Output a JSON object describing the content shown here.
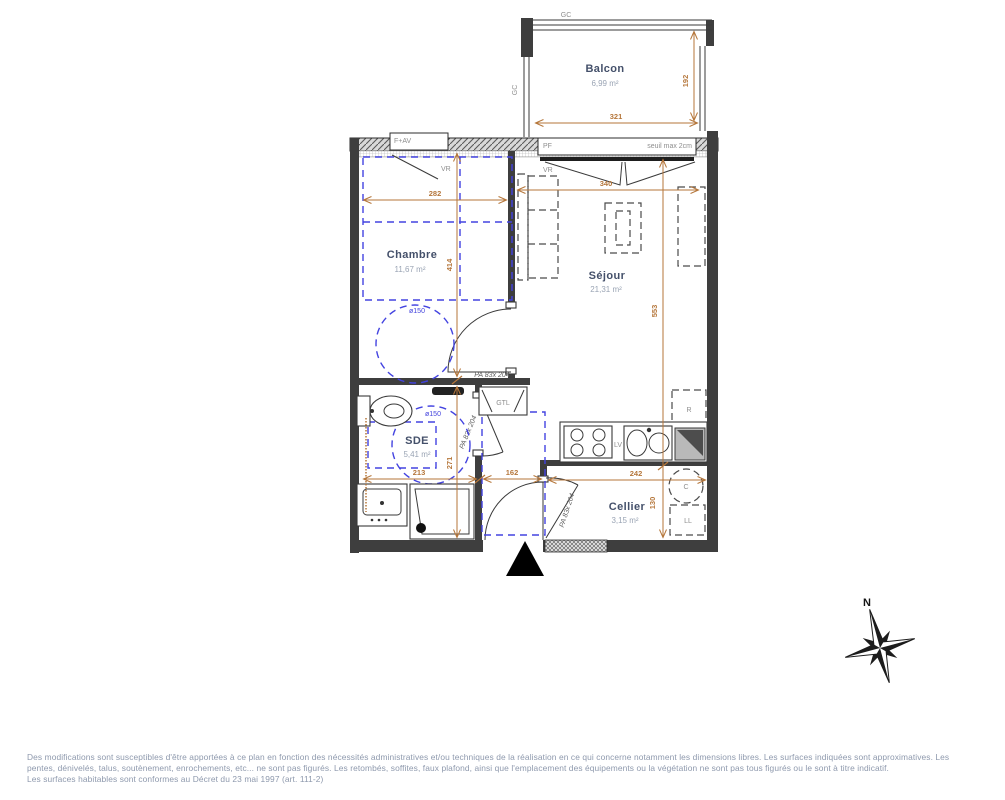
{
  "colors": {
    "wall": "#3e3e3e",
    "dimension": "#b5763a",
    "accessibility_blue": "#4343e0",
    "room_name": "#44506a",
    "room_area": "#9aa4b4",
    "footer_text": "#8e99ad"
  },
  "rooms": {
    "balcon": {
      "name": "Balcon",
      "area": "6,99 m²"
    },
    "chambre": {
      "name": "Chambre",
      "area": "11,67 m²"
    },
    "sejour": {
      "name": "Séjour",
      "area": "21,31 m²"
    },
    "sde": {
      "name": "SDE",
      "area": "5,41 m²"
    },
    "cellier": {
      "name": "Cellier",
      "area": "3,15 m²"
    }
  },
  "dims": {
    "balcony_width": "321",
    "balcony_depth": "192",
    "bedroom_width": "282",
    "bedroom_depth": "414",
    "living_width": "340",
    "living_depth": "553",
    "bathroom_width": "213",
    "bathroom_depth": "271",
    "entry_width": "162",
    "cellar_width": "242",
    "cellar_depth": "130"
  },
  "labels": {
    "railing": "GC",
    "window_bedroom": "F+AV",
    "french_window": "PF",
    "threshold": "seuil max 2cm",
    "roller_shutter": "VR",
    "door_spec": "PA 83x 204",
    "turning_circle": "ø150",
    "technical_duct": "GTL",
    "dishwasher": "LV",
    "fridge": "R",
    "water_heater": "C",
    "washing_machine": "LL"
  },
  "compass": {
    "north": "N"
  },
  "footer": {
    "line1": "Des modifications sont susceptibles d'être apportées à ce plan en fonction des nécessités administratives et/ou techniques de la réalisation en ce qui concerne notamment les dimensions libres. Les surfaces indiquées sont approximatives. Les",
    "line2": "pentes, dénivelés, talus, soutènement, enrochements, etc... ne sont pas figurés. Les retombés, soffites, faux plafond, ainsi que l'emplacement des équipements ou la végétation ne sont pas tous figurés ou le sont à titre indicatif.",
    "line3": "Les surfaces habitables sont conformes au Décret du 23 mai 1997 (art. 111-2)"
  }
}
